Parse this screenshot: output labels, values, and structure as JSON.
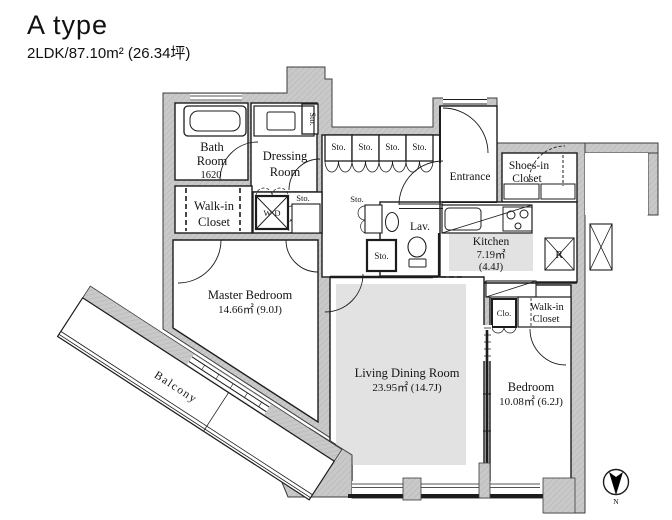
{
  "header": {
    "title": "A type",
    "subtitle": "2LDK/87.10m² (26.34坪)"
  },
  "labels": {
    "bath_l1": "Bath",
    "bath_l2": "Room",
    "bath_size": "1620",
    "dressing_l1": "Dressing",
    "dressing_l2": "Room",
    "wic_l1": "Walk-in",
    "wic_l2": "Closet",
    "master_name": "Master Bedroom",
    "master_area": "14.66㎡ (9.0J)",
    "ldr_name": "Living Dining Room",
    "ldr_area": "23.95㎡ (14.7J)",
    "bedroom_name": "Bedroom",
    "bedroom_area": "10.08㎡ (6.2J)",
    "kitchen_name": "Kitchen",
    "kitchen_area": "7.19㎡",
    "kitchen_tatami": "(4.4J)",
    "entrance": "Entrance",
    "shoes_l1": "Shoes-in",
    "shoes_l2": "Closet",
    "lav": "Lav.",
    "wd": "W·D",
    "clo": "Clo.",
    "fridge": "R",
    "sto": "Sto.",
    "balcony": "Balcony",
    "compass_n": "N"
  },
  "sto_row": [
    "Sto.",
    "Sto.",
    "Sto.",
    "Sto."
  ],
  "colors": {
    "wall": "#c9c9c9",
    "floor_shade": "#e2e2e2",
    "line": "#1c1c1c"
  }
}
